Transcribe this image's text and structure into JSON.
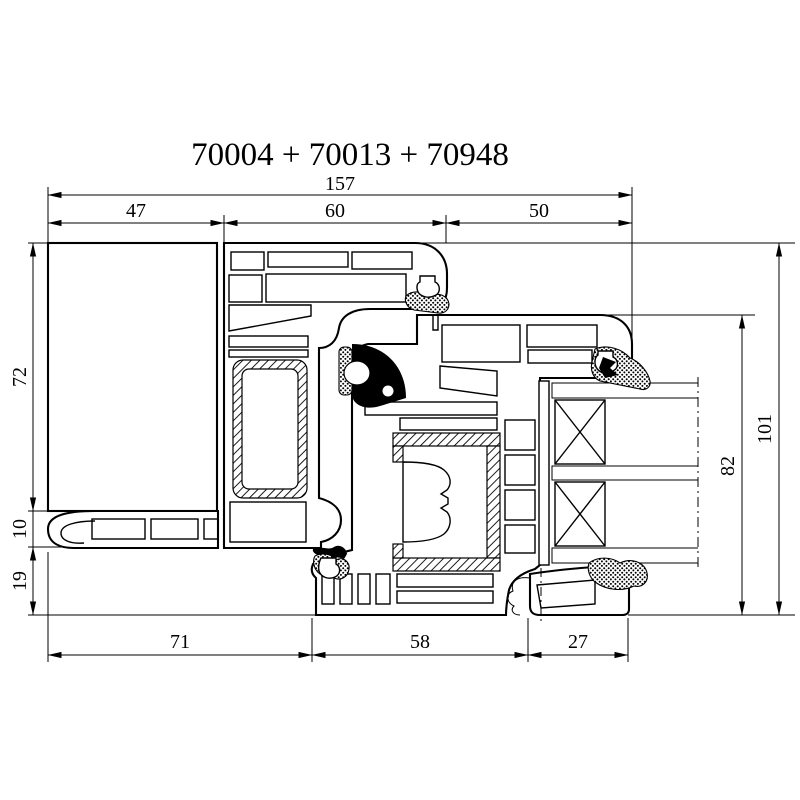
{
  "title": "70004 + 70013 + 70948",
  "drawing": {
    "type": "technical-cross-section",
    "line_color": "#000000",
    "background_color": "#ffffff",
    "dims": {
      "top_total": {
        "value": "157"
      },
      "top": [
        {
          "value": "47"
        },
        {
          "value": "60"
        },
        {
          "value": "50"
        }
      ],
      "left": [
        {
          "value": "72"
        },
        {
          "value": "10"
        },
        {
          "value": "19"
        }
      ],
      "right": [
        {
          "value": "101"
        },
        {
          "value": "82"
        }
      ],
      "bottom": [
        {
          "value": "71"
        },
        {
          "value": "58"
        },
        {
          "value": "27"
        }
      ]
    }
  }
}
